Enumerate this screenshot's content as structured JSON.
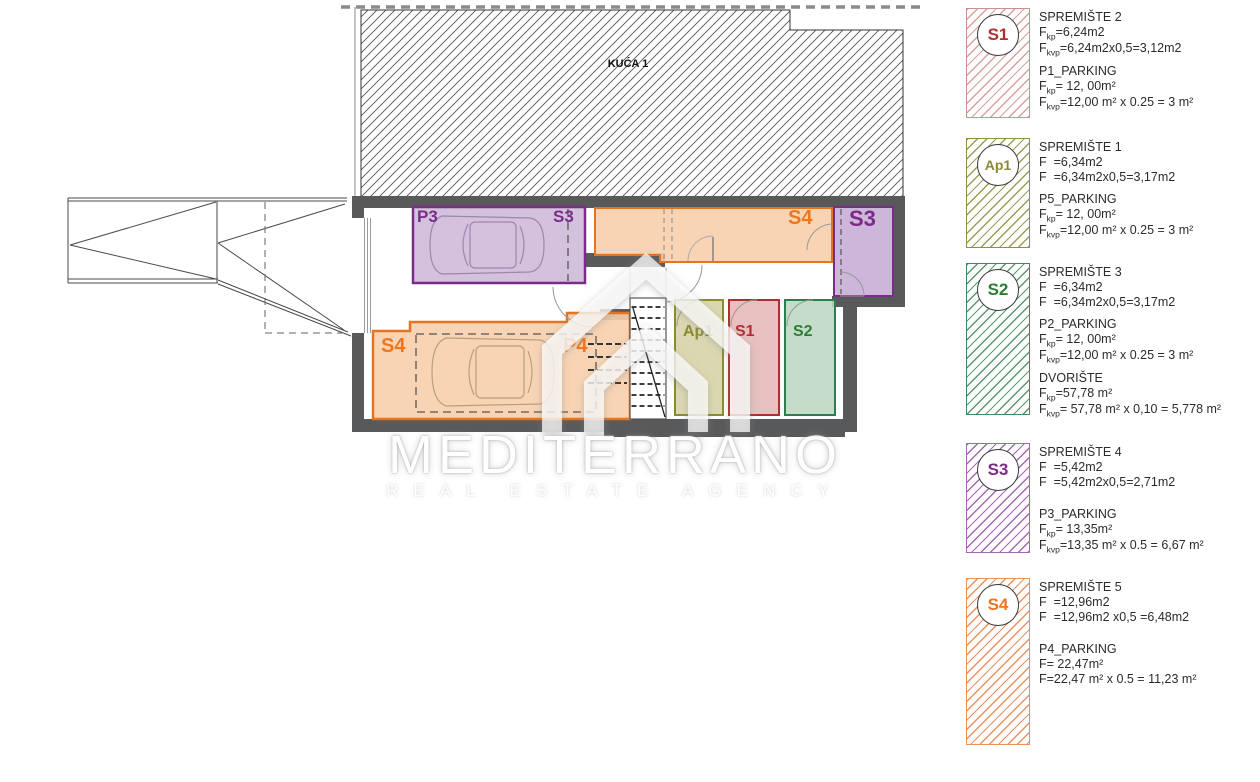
{
  "plan": {
    "building_label": "KUĆA 1",
    "labels": {
      "p3": "P3",
      "s3_inline": "S3",
      "s4_top": "S4",
      "s3_room": "S3",
      "s4_garage": "S4",
      "p4": "P4",
      "ap1": "Ap1",
      "s1": "S1",
      "s2": "S2"
    },
    "colors": {
      "wall": "#58595b",
      "orange": "#e6731f",
      "orange_fill": "#f7cfac",
      "purple": "#7a2c88",
      "purple_fill": "#cdb6d8",
      "olive": "#8a8a2e",
      "olive_fill": "#d5d1a3",
      "red": "#ad2f2f",
      "red_fill": "#e5b7b7",
      "green": "#2f7d4f",
      "green_fill": "#bdd7c4"
    }
  },
  "watermark": {
    "title": "MEDITERRANO",
    "subtitle": "REAL ESTATE AGENCY"
  },
  "legend": {
    "entries": [
      {
        "badge": "S1",
        "color": "#b03030",
        "sections": [
          {
            "title": "SPREMIŠTE 2",
            "lines": [
              {
                "pre": "F",
                "sub": "kp",
                "post": "=6,24m2"
              },
              {
                "pre": "F",
                "sub": "kvp",
                "post": "=6,24m2x0,5=3,12m2"
              }
            ]
          },
          {
            "title": "P1_PARKING",
            "lines": [
              {
                "pre": "F",
                "sub": "kp",
                "post": "= 12, 00m²"
              },
              {
                "pre": "F",
                "sub": "kvp",
                "post": "=12,00 m² x 0.25 = 3 m²"
              }
            ]
          }
        ]
      },
      {
        "badge": "Ap1",
        "color": "#8a8a2e",
        "sections": [
          {
            "title": "SPREMIŠTE 1",
            "lines": [
              {
                "pre": "F  =6,34m2"
              },
              {
                "pre": "F  =6,34m2x0,5=3,17m2"
              }
            ]
          },
          {
            "title": "P5_PARKING",
            "lines": [
              {
                "pre": "F",
                "sub": "kp",
                "post": "= 12, 00m²"
              },
              {
                "pre": "F",
                "sub": "kvp",
                "post": "=12,00 m² x 0.25 = 3 m²"
              }
            ]
          }
        ]
      },
      {
        "badge": "S2",
        "color": "#2e7d32",
        "sections": [
          {
            "title": "SPREMIŠTE 3",
            "lines": [
              {
                "pre": "F  =6,34m2"
              },
              {
                "pre": "F  =6,34m2x0,5=3,17m2"
              }
            ]
          },
          {
            "title": "P2_PARKING",
            "lines": [
              {
                "pre": "F",
                "sub": "kp",
                "post": "= 12, 00m²"
              },
              {
                "pre": "F",
                "sub": "kvp",
                "post": "=12,00 m² x 0.25 = 3 m²"
              }
            ]
          },
          {
            "title": "DVORIŠTE",
            "lines": [
              {
                "pre": "F",
                "sub": "kp",
                "post": "=57,78 m²"
              },
              {
                "pre": "F",
                "sub": "kvp",
                "post": "= 57,78 m² x 0,10 = 5,778 m²"
              }
            ]
          }
        ]
      },
      {
        "badge": "S3",
        "color": "#7a2c88",
        "sections": [
          {
            "title": "SPREMIŠTE 4",
            "lines": [
              {
                "pre": "F  =5,42m2"
              },
              {
                "pre": "F  =5,42m2x0,5=2,71m2"
              }
            ]
          },
          {
            "title": "P3_PARKING",
            "lines": [
              {
                "pre": "F",
                "sub": "kp",
                "post": "= 13,35m²"
              },
              {
                "pre": "F",
                "sub": "kvp",
                "post": "=13,35 m² x 0.5 = 6,67 m²"
              }
            ]
          }
        ]
      },
      {
        "badge": "S4",
        "color": "#ef7520",
        "sections": [
          {
            "title": "SPREMIŠTE 5",
            "lines": [
              {
                "pre": "F  =12,96m2"
              },
              {
                "pre": "F  =12,96m2 x0,5 =6,48m2"
              }
            ]
          },
          {
            "title": "P4_PARKING",
            "lines": [
              {
                "pre": "F= 22,47m²"
              },
              {
                "pre": "F=22,47 m² x 0.5 = 11,23 m²"
              }
            ]
          }
        ]
      }
    ]
  }
}
